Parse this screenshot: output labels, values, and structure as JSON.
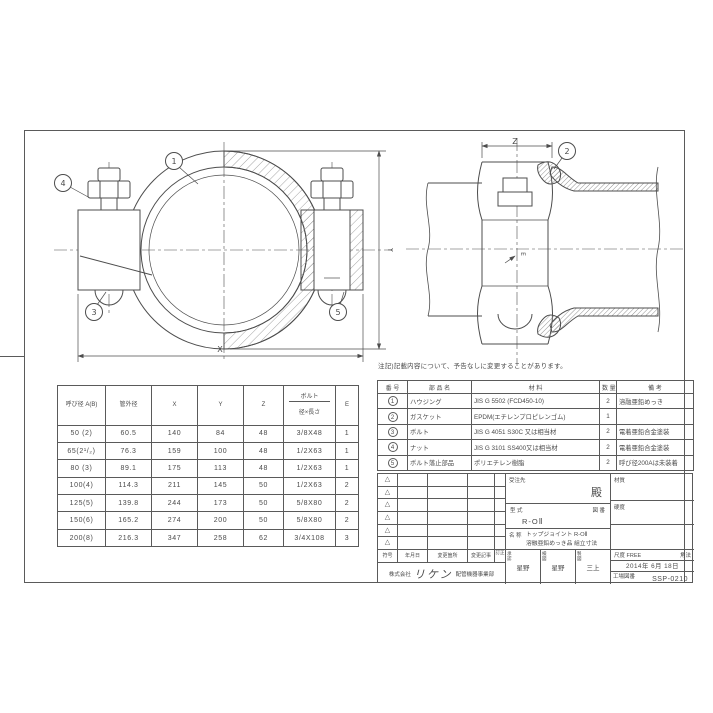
{
  "drawing_note": "注記)記載内容について、予告なしに変更することがあります。",
  "views": {
    "front": {
      "callouts": {
        "housing": "1",
        "bolt": "3",
        "nut": "4",
        "retainer": "5"
      },
      "dims": {
        "x": "X",
        "y": "Y"
      }
    },
    "side": {
      "callouts": {
        "gasket": "2"
      },
      "dims": {
        "z": "Z",
        "e": "E"
      }
    }
  },
  "dimension_table": {
    "headers": [
      "呼び径 A(B)",
      "管外径",
      "X",
      "Y",
      "Z",
      {
        "top": "ボルト",
        "bottom": "径×長さ"
      },
      "E"
    ],
    "rows": [
      [
        "50 (2)",
        "60.5",
        "140",
        "84",
        "48",
        "3/8X48",
        "1"
      ],
      [
        "65(2¹/₂)",
        "76.3",
        "159",
        "100",
        "48",
        "1/2X63",
        "1"
      ],
      [
        "80 (3)",
        "89.1",
        "175",
        "113",
        "48",
        "1/2X63",
        "1"
      ],
      [
        "100(4)",
        "114.3",
        "211",
        "145",
        "50",
        "1/2X63",
        "2"
      ],
      [
        "125(5)",
        "139.8",
        "244",
        "173",
        "50",
        "5/8X80",
        "2"
      ],
      [
        "150(6)",
        "165.2",
        "274",
        "200",
        "50",
        "5/8X80",
        "2"
      ],
      [
        "200(8)",
        "216.3",
        "347",
        "258",
        "62",
        "3/4X108",
        "3"
      ]
    ]
  },
  "parts_table": {
    "headers": [
      "番 号",
      "部 品 名",
      "材 料",
      "数 量",
      "備 考"
    ],
    "rows": [
      [
        "1",
        "ハウジング",
        "JIS G 5502 (FCD450-10)",
        "2",
        "溶融亜鉛めっき"
      ],
      [
        "2",
        "ガスケット",
        "EPDM(エチレンプロピレンゴム)",
        "1",
        ""
      ],
      [
        "3",
        "ボルト",
        "JIS G 4051 S30C 又は相当材",
        "2",
        "電着亜鉛合金塗装"
      ],
      [
        "4",
        "ナット",
        "JIS G 3101 SS400又は相当材",
        "2",
        "電着亜鉛合金塗装"
      ],
      [
        "5",
        "ボルト落止部品",
        "ポリエチレン樹脂",
        "2",
        "呼び径200Aは未装着"
      ]
    ]
  },
  "title_block": {
    "rev_mark": "△",
    "rev_headers": [
      "符号",
      "年月日",
      "変更箇所",
      "変更記事",
      "訂正"
    ],
    "customer_label": "受注先",
    "honorific": "殿",
    "material_label": "材質",
    "hardness_label": "硬度",
    "model_label": "型 式",
    "drawing_no_label": "図 番",
    "model_value": "R-OⅡ",
    "name_label": "名 称",
    "name_line1": "トップジョイント R-OⅡ",
    "name_line2": "溶融亜鉛めっき品 組立寸法",
    "approved_label": "承認",
    "approved_value": "星野",
    "checked_label": "検図",
    "checked_value": "星野",
    "drawn_label": "製図",
    "drawn_value": "三上",
    "scale_label": "尺度",
    "scale_value": "FREE",
    "projection_label": "角法",
    "date": "2014年  6月 18日",
    "factory_drawing_no_label": "工場図番",
    "factory_drawing_no": "SSP-0210",
    "company_prefix": "株式会社",
    "company_name": "リケン",
    "company_division": "配管機器事業部"
  }
}
